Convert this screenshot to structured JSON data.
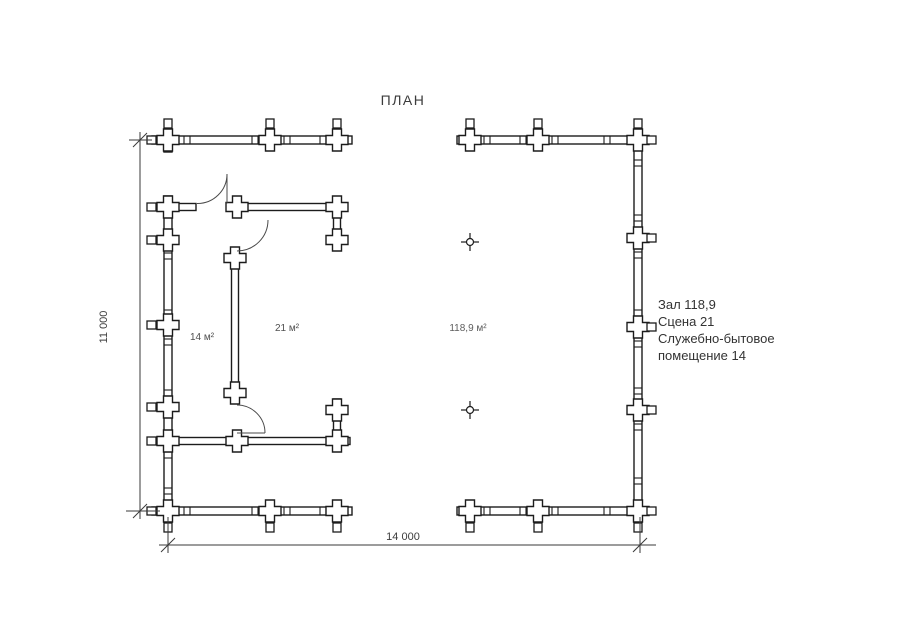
{
  "title": "ПЛАН",
  "dimensions": {
    "vertical": "11 000",
    "horizontal": "14 000"
  },
  "rooms": {
    "room_small": "14 м²",
    "room_medium": "21 м²",
    "hall": "118,9 м²"
  },
  "legend": {
    "lines": [
      "Зал 118,9",
      "Сцена 21",
      "Служебно-бытовое",
      "помещение 14"
    ]
  },
  "colors": {
    "line": "#1c1c1c",
    "dimension_line": "#3a3a3a",
    "label_text": "#3c3c3c",
    "hall_label_text": "#5d5d5d",
    "background": "#ffffff"
  }
}
